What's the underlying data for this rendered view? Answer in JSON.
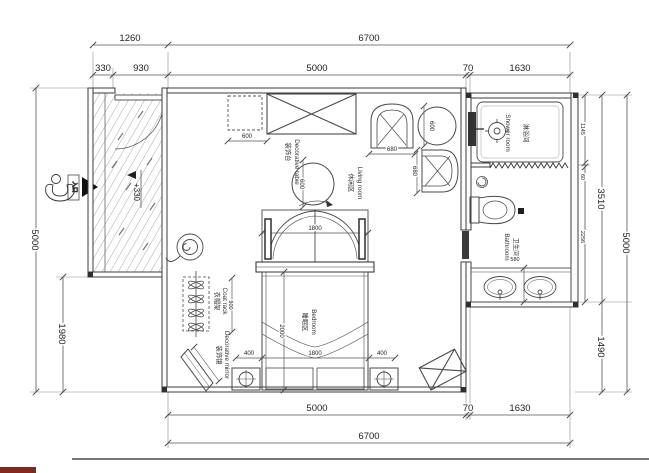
{
  "dims": {
    "top_row1": {
      "w1260": "1260",
      "w6700": "6700"
    },
    "top_row2": {
      "w330": "330",
      "w930": "930",
      "w5000": "5000",
      "w70": "70",
      "w1630": "1630"
    },
    "bottom_row1": {
      "w5000": "5000",
      "w70": "70",
      "w1630": "1630"
    },
    "bottom_row2": {
      "w6700": "6700"
    },
    "left": {
      "h5000": "5000",
      "h1980": "1980"
    },
    "right": {
      "h1145": "1145",
      "h60": "60",
      "h2256": "2256",
      "h3510": "3510",
      "h5000": "5000",
      "h1490": "1490"
    },
    "interior": {
      "cabinet_w": "600",
      "round_table": "600",
      "chair_w": "680",
      "chair_d": "680",
      "side_table": "600",
      "bed_head_w": "1800",
      "bed_len": "2000",
      "nightstand_l": "400",
      "bed_w": "1800",
      "nightstand_r": "400",
      "coat_rack_h": "900",
      "vanity_d": "580"
    },
    "level_entry": "+330"
  },
  "rooms": {
    "shower": {
      "zh": "淋浴间",
      "en": "Shower room"
    },
    "bathroom": {
      "zh": "卫生间",
      "en": "Bathroom"
    },
    "living": {
      "zh": "休闲区",
      "en": "Living room"
    },
    "bedroom": {
      "zh": "睡眠区",
      "en": "Bedroom"
    }
  },
  "labels": {
    "coat_rack": {
      "zh": "衣帽架",
      "en": "Coat rack"
    },
    "decor_table": {
      "zh": "装饰台",
      "en": "Decorative table"
    },
    "decor_mirror": {
      "zh": "装饰镜",
      "en": "Decorative mirror"
    },
    "entry": "入口"
  }
}
